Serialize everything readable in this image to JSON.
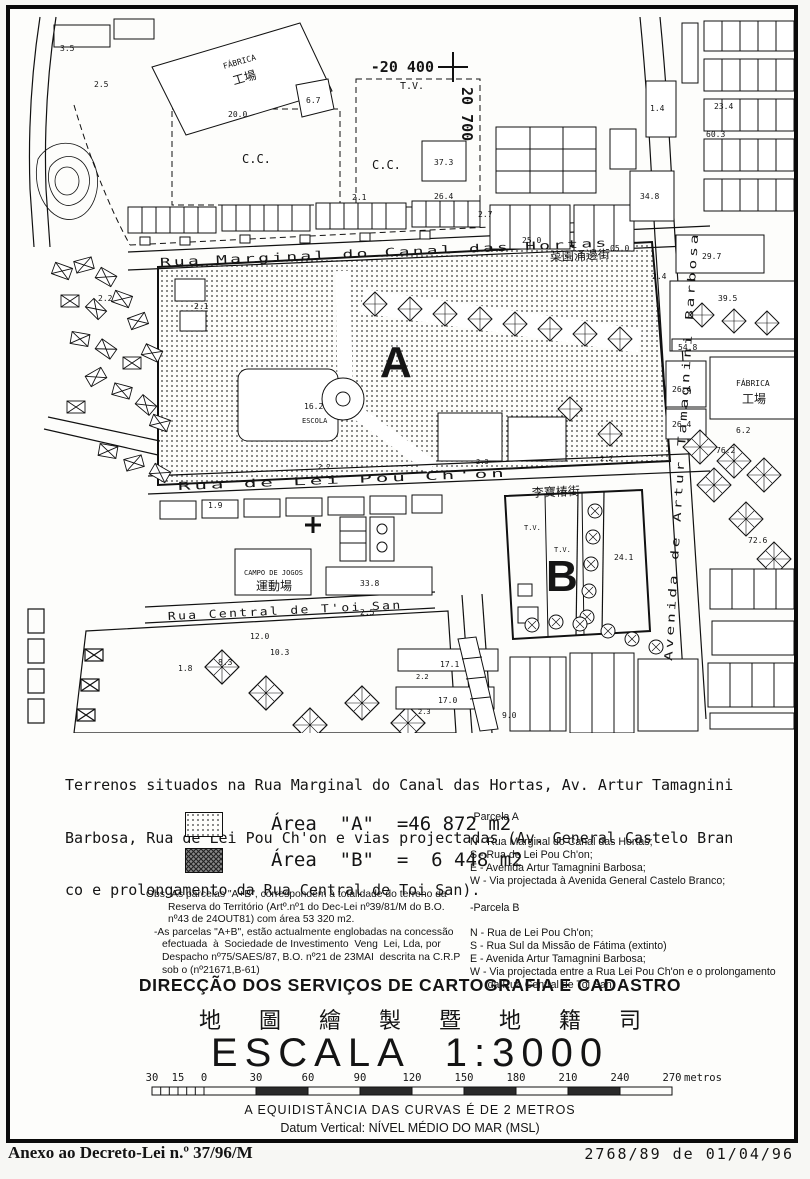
{
  "map": {
    "grid": {
      "x": "-20 400",
      "tv": "T.V.",
      "y": "20 700"
    },
    "marker_a": "A",
    "marker_b": "B",
    "streets": {
      "marginal": "Rua  Marginal  do  Canal  das  Hortas",
      "marginal_zh": "菜園涌邊街",
      "leipou": "Rua  de  Lei  Pou  Ch'on",
      "leipou_zh": "李寶椿街",
      "avenida": "Avenida  de  Artur  Tamagnini  Barbosa",
      "toisan": "Rua  Central  de  T'oi  San"
    },
    "labels": {
      "fabrica1": "FÁBRICA",
      "fabrica1_zh": "工場",
      "n200": "20.0",
      "n35": "3.5",
      "n25": "2.5",
      "n67": "6.7",
      "cc1": "C.C.",
      "cc2": "C.C.",
      "n373": "37.3",
      "n264": "26.4",
      "n21a": "2.1",
      "n27": "2.7",
      "n250": "25.0",
      "n050": "05.0",
      "n24a": "2.4",
      "n14": "1.4",
      "n234": "23.4",
      "n603": "60.3",
      "n348": "34.8",
      "n21b": "2.1",
      "n162": "16.2",
      "escola": "ESCOLA",
      "n22p": "2.2",
      "n23p": "2.3",
      "n22q": "2.2",
      "n297": "29.7",
      "n395": "39.5",
      "n548": "54.8",
      "fabrica2": "FÁBRICA",
      "fabrica2_zh": "工場",
      "n264b": "26.4",
      "n264c": "26.4",
      "n62": "6.2",
      "n762": "76.2",
      "n726": "72.6",
      "tv1": "T.V.",
      "tv2": "T.V.",
      "n241": "24.1",
      "campo": "CAMPO  DE  JOGOS",
      "campo_zh": "運動場",
      "n338": "33.8",
      "n120": "12.0",
      "n103": "10.3",
      "n83": "8.3",
      "n171": "17.1",
      "n170": "17.0",
      "n22r": "2.2",
      "n23r": "2.3",
      "n90": "9.0",
      "n19": "1.9",
      "n18": "1.8",
      "n22L": "2.2",
      "n25c": "2.5"
    }
  },
  "description": {
    "line1": "Terrenos situados na Rua Marginal do Canal das Hortas, Av. Artur Tamagnini",
    "line2": "Barbosa, Rua de Lei Pou Ch'on e vias projectadas (Av. General Castelo Bran",
    "line3": "co e prolongamento da Rua Central de Toi San)."
  },
  "legend": {
    "a_text": "Área  \"A\"  =46 872 m2",
    "b_text": "Área  \"B\"  =  6 448 m2"
  },
  "parcela_a": {
    "title": "-Parcela A",
    "items": [
      "N - Rua Marginal do Canal das Hortas;",
      "S - Rua de Lei Pou Ch'on;",
      "E - Avenida Artur Tamagnini Barbosa;",
      "W - Via projectada à Avenida General Castelo Branco;"
    ]
  },
  "parcela_b": {
    "title": "-Parcela B",
    "items": [
      "N - Rua de Lei Pou Ch'on;",
      "S - Rua Sul da Missão de Fátima (extinto)",
      "E - Avenida Artur Tamagnini Barbosa;",
      "W - Via projectada entre a Rua Lei Pou Ch'on e o prolongamento",
      "      da Rua Central de Toi San;"
    ]
  },
  "obs": {
    "lines": [
      "Obs:-As parcelas \"A+B\", correspondem à totalidade do terreno da",
      "Reserva do Território (Artº.nº1 do Dec-Lei nº39/81/M do B.O.",
      "nº43 de 24OUT81) com área 53 320 m2.",
      "-As parcelas \"A+B\", estão actualmente englobadas na concessão",
      "efectuada  à  Sociedade de Investimento  Veng  Lei, Lda, por",
      "Despacho nº75/SAES/87, B.O. nº21 de 23MAI  descrita na C.R.P",
      "sob o (nº21671,B-61)"
    ]
  },
  "org": {
    "title": "DIRECÇÃO DOS SERVIÇOS DE CARTOGRAFIA E CADASTRO",
    "title_zh": "地圖繪製暨地籍司",
    "scale_line": "ESCALA  1:3000"
  },
  "scalebar": {
    "ticks": [
      "30",
      "15",
      "0",
      "30",
      "60",
      "90",
      "120",
      "150",
      "180",
      "210",
      "240",
      "270"
    ],
    "unit": "metros"
  },
  "notes": {
    "equidist": "A EQUIDISTÂNCIA DAS CURVAS É DE 2 METROS",
    "datum": "Datum Vertical: NÍVEL MÉDIO DO MAR (MSL)"
  },
  "footer": {
    "left": "Anexo ao Decreto-Lei n.º 37/96/M",
    "right": "2768/89 de 01/04/96"
  }
}
